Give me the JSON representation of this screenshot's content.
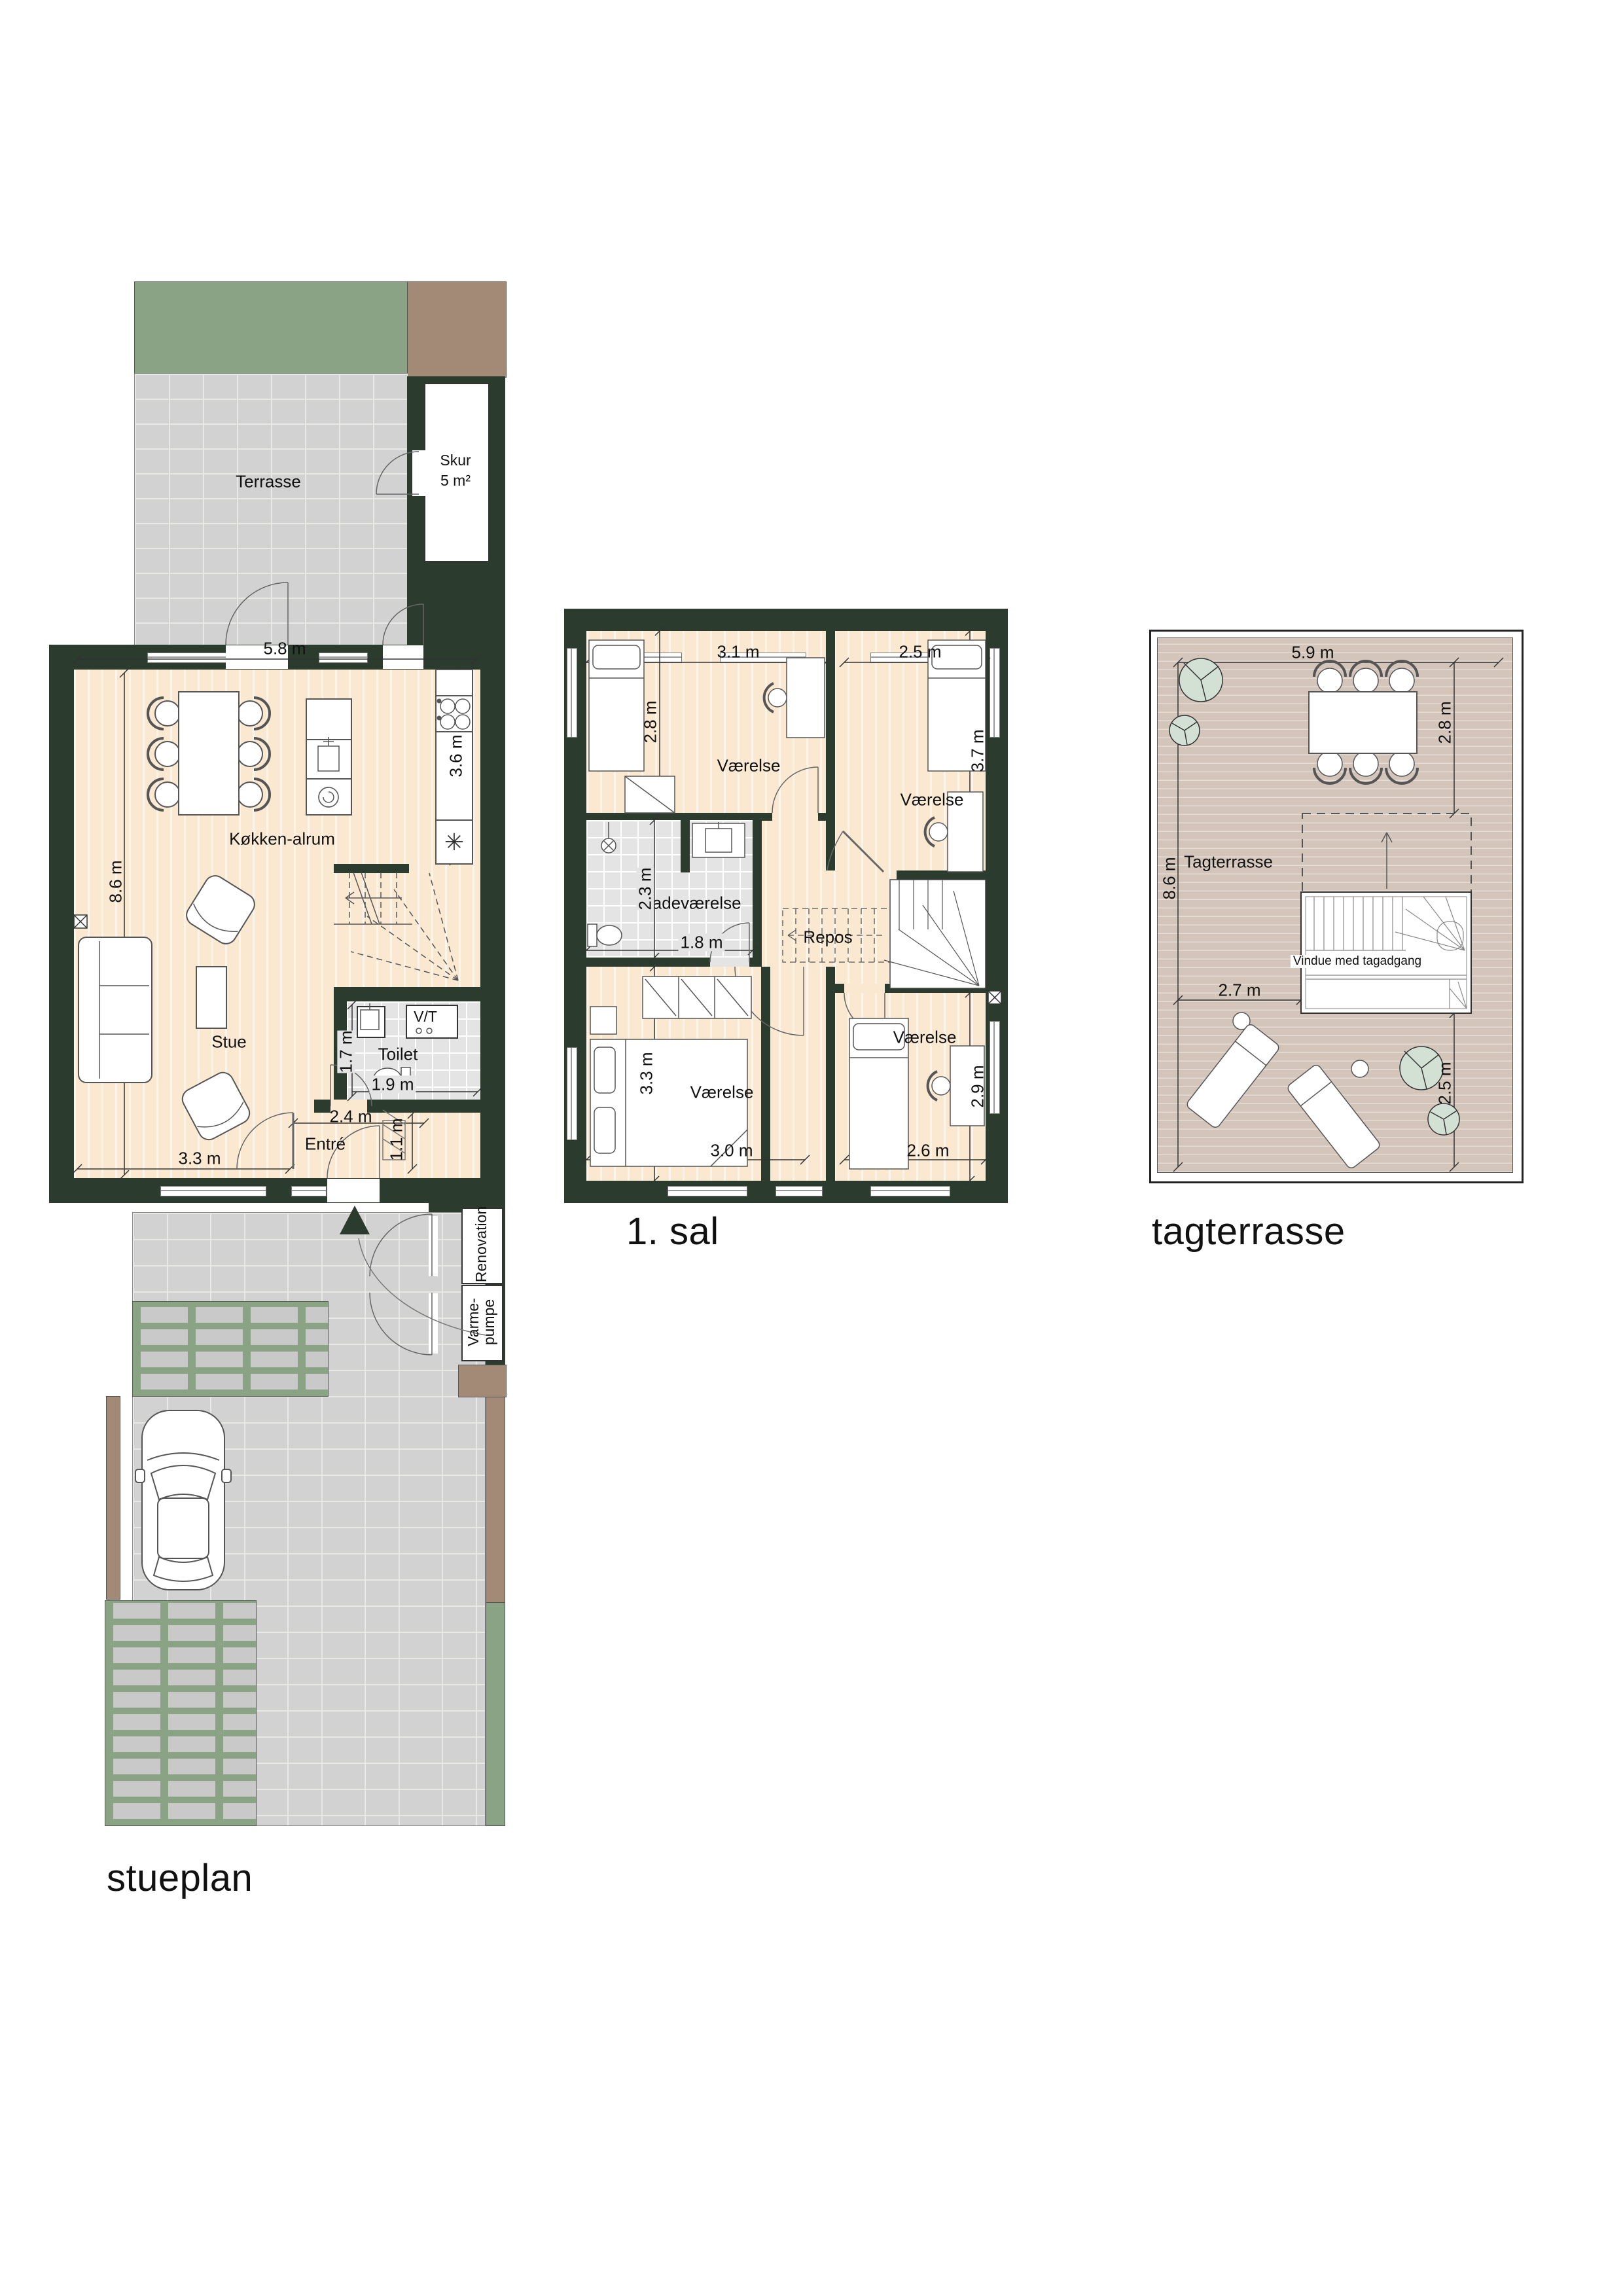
{
  "colors": {
    "wall": "#2b3b2d",
    "floor": "#fae8d1",
    "tile": "#e4e4e4",
    "paving": "#d2d2d2",
    "grass": "#8ba385",
    "hedge": "#a38a76",
    "roofFloor": "#d4c5bb",
    "plant": "#d3e1d5"
  },
  "stueplan": {
    "title": "stueplan",
    "terrasse": "Terrasse",
    "skur": "Skur",
    "skur_area": "5 m²",
    "kokken_alrum": "Køkken-alrum",
    "stue": "Stue",
    "toilet": "Toilet",
    "vt": "V/T",
    "entre": "Entré",
    "renovation": "Renovation",
    "varmepumpe_line1": "Varme-",
    "varmepumpe_line2": "pumpe",
    "freezer_icon": "✳",
    "dim_top": "5.8 m",
    "dim_left": "8.6 m",
    "dim_kitchen": "3.6 m",
    "dim_toilet_depth": "1.7 m",
    "dim_toilet_width": "1.9 m",
    "dim_entre_width": "2.4 m",
    "dim_entre_depth": "1.1 m",
    "dim_stue": "3.3 m"
  },
  "first_floor": {
    "title": "1. sal",
    "room_nw": "Værelse",
    "room_ne": "Værelse",
    "room_sw": "Værelse",
    "room_se": "Værelse",
    "badevaerelse": "Badeværelse",
    "repos": "Repos",
    "dim_nw_w": "3.1 m",
    "dim_nw_h": "2.8 m",
    "dim_ne_w": "2.5 m",
    "dim_ne_h": "3.7 m",
    "dim_bad_h": "2.3 m",
    "dim_bad_w": "1.8 m",
    "dim_sw_h": "3.3 m",
    "dim_sw_w": "3.0 m",
    "dim_se_w": "2.6 m",
    "dim_se_h": "2.9 m"
  },
  "roof": {
    "title": "tagterrasse",
    "tagterrasse": "Tagterrasse",
    "vindue": "Vindue med tagadgang",
    "dim_w": "5.9 m",
    "dim_h": "8.6 m",
    "dim_ne": "2.8 m",
    "dim_mid": "2.7 m",
    "dim_se": "2.5 m"
  }
}
